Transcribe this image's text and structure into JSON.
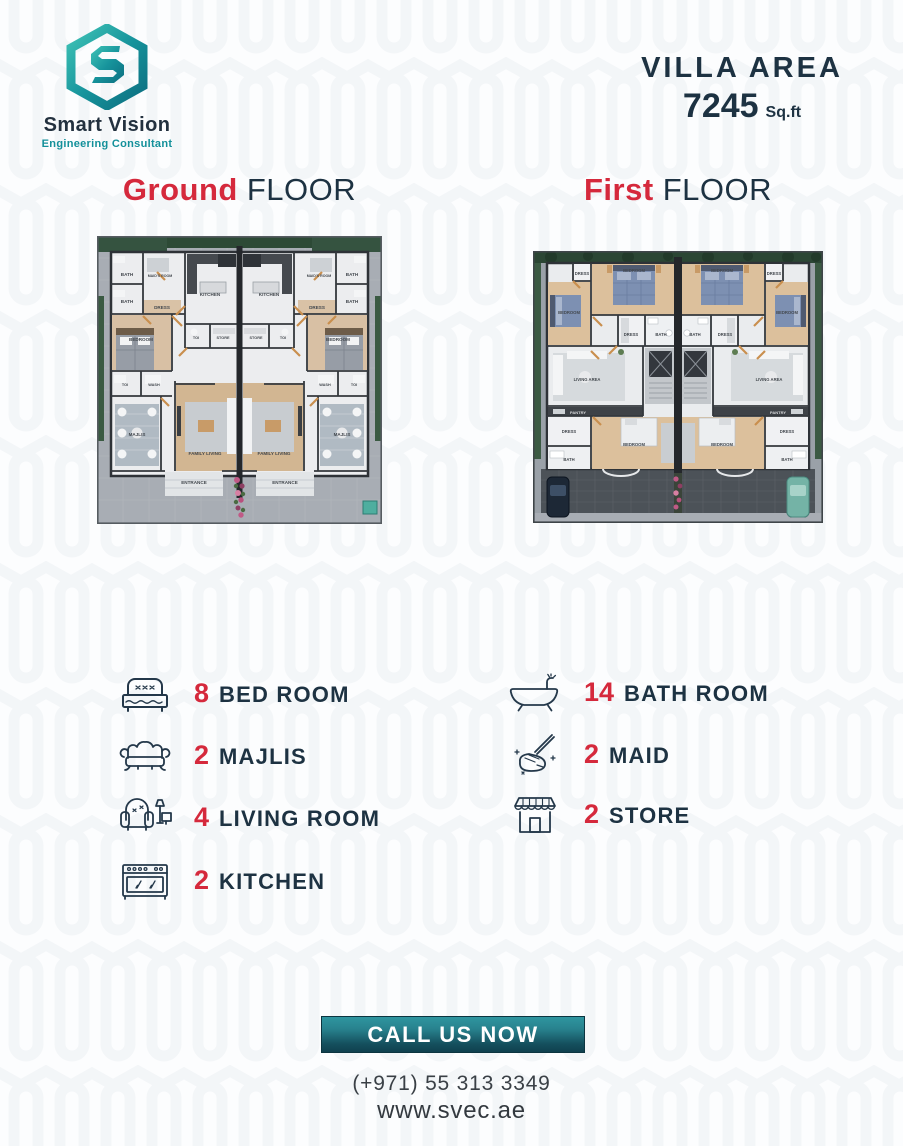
{
  "brand": {
    "name": "Smart Vision",
    "tagline": "Engineering Consultant",
    "initial": "S"
  },
  "villa_area": {
    "label": "VILLA AREA",
    "value": "7245",
    "unit": "Sq.ft"
  },
  "floors": [
    {
      "highlight": "Ground",
      "rest": "FLOOR"
    },
    {
      "highlight": "First",
      "rest": "FLOOR"
    }
  ],
  "plans": {
    "ground": {
      "rooms": {
        "bath": "BATH",
        "maids_room": "MAID'S ROOM",
        "dress": "DRESS",
        "bedroom": "BEDROOM",
        "kitchen": "KITCHEN",
        "toilet": "TOI",
        "store": "STORE",
        "wash": "WASH",
        "majlis": "MAJLIS",
        "family_living": "FAMILY LIVING",
        "entrance": "ENTRANCE"
      }
    },
    "first": {
      "rooms": {
        "dress": "DRESS",
        "bedroom": "BEDROOM",
        "bath": "BATH",
        "living_area": "LIVING AREA",
        "pantry": "PANTRY"
      }
    }
  },
  "features": {
    "left": [
      {
        "count": "8",
        "label": "BED ROOM",
        "icon": "bed-icon"
      },
      {
        "count": "2",
        "label": "MAJLIS",
        "icon": "sofa-icon"
      },
      {
        "count": "4",
        "label": "LIVING ROOM",
        "icon": "armchair-lamp-icon"
      },
      {
        "count": "2",
        "label": "KITCHEN",
        "icon": "stove-icon"
      }
    ],
    "right": [
      {
        "count": "14",
        "label": "BATH ROOM",
        "icon": "bathtub-icon"
      },
      {
        "count": "2",
        "label": "MAID",
        "icon": "mop-icon"
      },
      {
        "count": "2",
        "label": "STORE",
        "icon": "shop-icon"
      }
    ]
  },
  "cta": {
    "button": "CALL US NOW",
    "phone": "(+971) 55 313 3349",
    "website": "www.svec.ae"
  },
  "colors": {
    "accent_red": "#d5293c",
    "navy": "#1d3242",
    "teal": "#13909a",
    "button_gradient_top": "#2f97a1",
    "button_gradient_bottom": "#0f3e4c"
  }
}
